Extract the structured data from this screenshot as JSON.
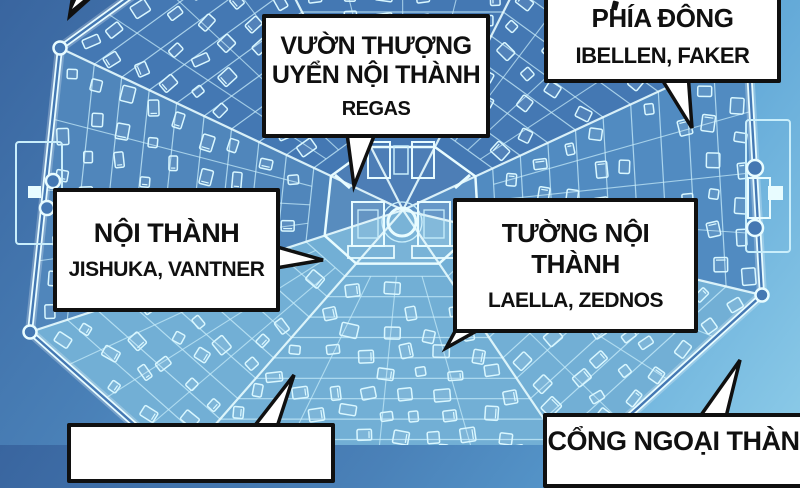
{
  "callouts": {
    "regas": {
      "title_lines": [
        "VƯỜN THƯỢNG",
        "UYỂN NỘI THÀNH"
      ],
      "subtitle": "REGAS"
    },
    "phia_dong": {
      "title": "PHÍA ĐÔNG",
      "subtitle": "IBELLEN, FAKER"
    },
    "noi_thanh": {
      "title": "NỘI THÀNH",
      "subtitle": "JISHUKA, VANTNER"
    },
    "tuong_noi_thanh": {
      "title": "TƯỜNG NỘI THÀNH",
      "subtitle": "LAELLA, ZEDNOS"
    },
    "cong_ngoai_thanh": {
      "title": "CỔNG NGOẠI THÀNH"
    }
  },
  "colors": {
    "bg_top": "#39659f",
    "bg_bottom": "#8ccbe8",
    "city_fill": "#4478b3",
    "city_fill_light": "#8ed2ea",
    "map_line": "#c9eefb",
    "map_line_bright": "#e8fcff",
    "box_bg": "#ffffff",
    "box_border": "#101010",
    "text": "#101010"
  }
}
